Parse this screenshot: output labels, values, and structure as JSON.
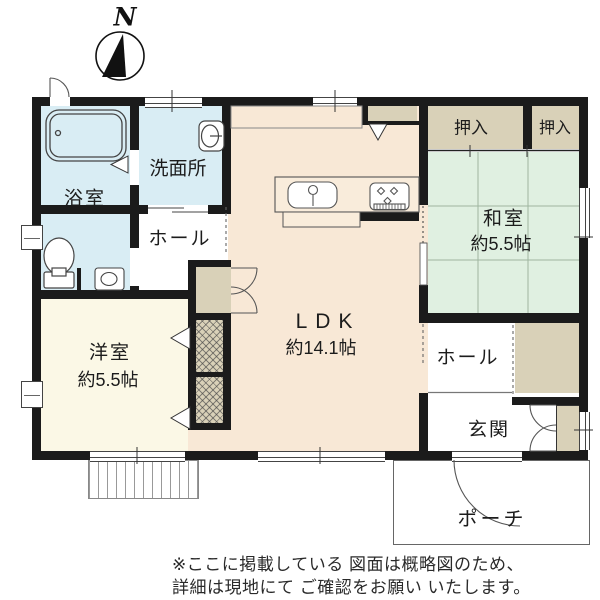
{
  "compass": {
    "label": "N"
  },
  "rooms": {
    "bathroom": {
      "label": "浴室"
    },
    "washroom": {
      "label": "洗面所"
    },
    "hall_upper": {
      "label": "ホール"
    },
    "western_room": {
      "label": "洋室",
      "size": "約5.5帖"
    },
    "ldk": {
      "label": "LDK",
      "size": "約14.1帖"
    },
    "closet_left": {
      "label": "押入"
    },
    "closet_right": {
      "label": "押入"
    },
    "japanese_room": {
      "label": "和室",
      "size": "約5.5帖"
    },
    "hall_lower": {
      "label": "ホール"
    },
    "entrance": {
      "label": "玄関"
    },
    "porch": {
      "label": "ポーチ"
    }
  },
  "disclaimer": {
    "line1": "※ここに掲載している 図面は概略図のため、",
    "line2": "詳細は現地にて ご確認をお願い いたします。"
  },
  "colors": {
    "wall": "#1b1b1b",
    "wet_room": "#d9edf4",
    "ldk": "#f8e8d6",
    "western_room": "#fbf8e6",
    "tatami": "#e0f0e1",
    "closet": "#d9d1b8"
  }
}
